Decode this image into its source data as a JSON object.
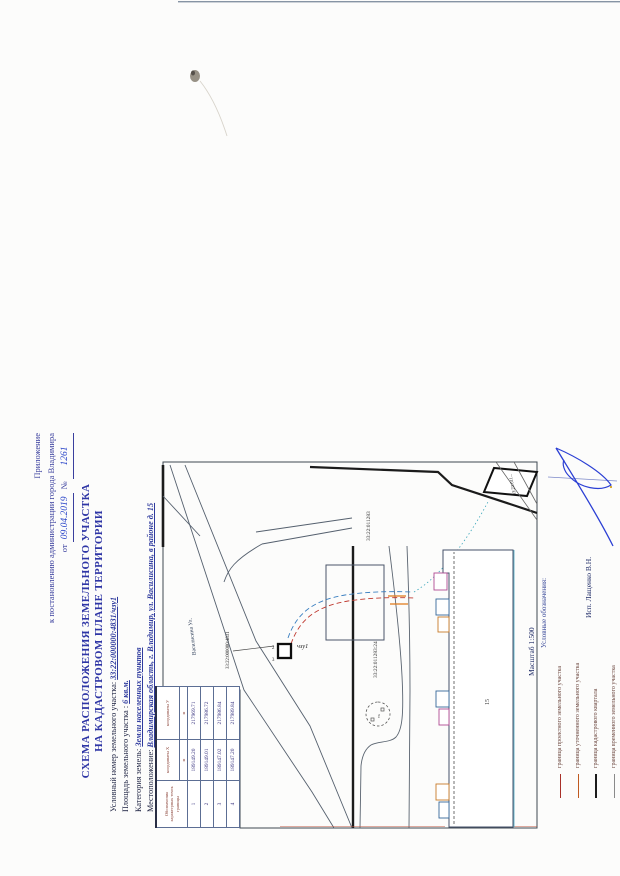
{
  "appendix": {
    "line1": "Приложение",
    "line2": "к постановлению администрации города Владимира",
    "date_prefix": "от",
    "date_value": "09.04.2019",
    "number_sign": "№",
    "number_value": "1261"
  },
  "title": {
    "line1": "СХЕМА РАСПОЛОЖЕНИЯ  ЗЕМЕЛЬНОГО УЧАСТКА",
    "line2": "НА КАДАСТРОВОМ ПЛАНЕ ТЕРРИТОРИИ"
  },
  "fields": [
    {
      "label": "Условный номер земельного участка:",
      "value": "33:22:000000:4831/чзу1"
    },
    {
      "label": "Площадь  земельного участка :",
      "value": "6 кв.м."
    },
    {
      "label": "Категория земель:",
      "value": "Земли населенных пунктов"
    },
    {
      "label": "Местоположение:",
      "value": "Владимирская область, г. Владимир, ул. Василисина, в районе д. 15"
    }
  ],
  "table": {
    "header_col1": "Обозначения характерных точек границы",
    "header_col2": "координаты X",
    "header_col3": "координаты У",
    "unit": "м",
    "rows": [
      {
        "pt": "1",
        "x": "189149.20",
        "y": "217969.71"
      },
      {
        "pt": "2",
        "x": "189149.01",
        "y": "217986.72"
      },
      {
        "pt": "3",
        "x": "189147.02",
        "y": "217986.84"
      },
      {
        "pt": "4",
        "x": "189147.20",
        "y": "217989.84"
      }
    ]
  },
  "map": {
    "labels": {
      "street": "Василисина Ул.",
      "leader_parcel": "33:22:000000:4831",
      "subject_parcel": "чзу1",
      "point2": "2",
      "point3": "3",
      "quarter": "33:22:011283",
      "road_parcel": "33:22:011283:24",
      "corner_parcel": "33:22:011...",
      "house_number": "15",
      "well": "тк"
    }
  },
  "scale": {
    "label": "Масштаб 1:500"
  },
  "legend": {
    "header": "Условные обозначения:",
    "items": [
      {
        "label": "граница проектного земельного участка",
        "color": "#a83028",
        "thickness": 1.2
      },
      {
        "label": "граница уточненного земельного участка",
        "color": "#c05a20",
        "thickness": 1.2
      },
      {
        "label": "граница кадастрового квартала",
        "color": "#1c1c1c",
        "thickness": 2
      },
      {
        "label": "граница временного земельного участка",
        "color": "#8a8a8a",
        "thickness": 1.2
      }
    ]
  },
  "executor": {
    "label": "Исп. Лащенко В.Н."
  },
  "colors": {
    "title_blue": "#2e35a5",
    "print_blue": "#3a3f9e",
    "ink_blue": "#2742c8",
    "value_navy": "#3a3580",
    "header_red": "#8a4136",
    "frame": "#3e4852",
    "thick_boundary": "#1b1b1b"
  }
}
